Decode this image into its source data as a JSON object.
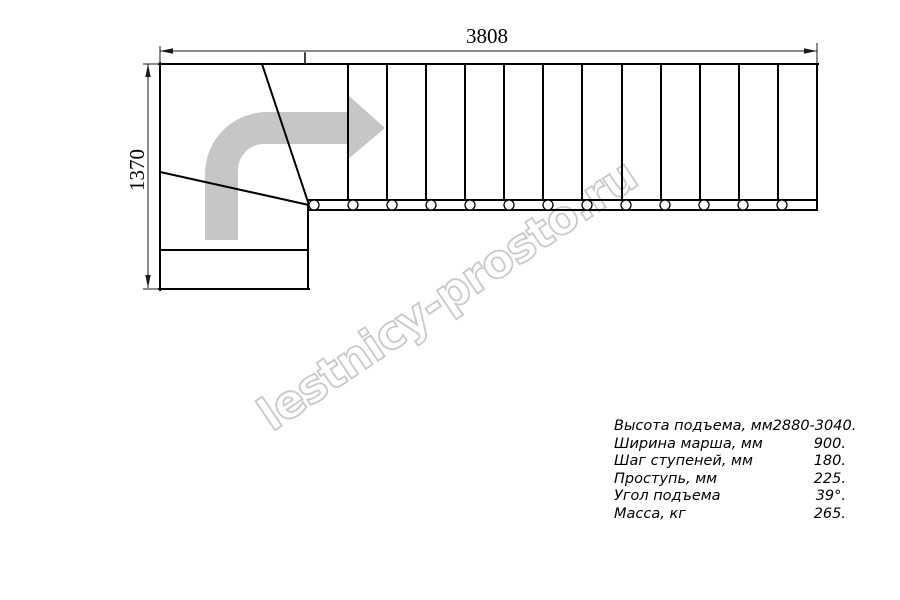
{
  "watermark": {
    "text": "lestnicy-prosto.ru"
  },
  "dimensions": {
    "width_label": "3808",
    "height_label": "1370"
  },
  "specs": {
    "rows": [
      {
        "label": "Высота подъема, мм",
        "value": "2880-3040."
      },
      {
        "label": "Ширина марша, мм",
        "value": "900."
      },
      {
        "label": "Шаг ступеней, мм",
        "value": "180."
      },
      {
        "label": "Проступь, мм",
        "value": "225."
      },
      {
        "label": "Угол подъема",
        "value": "39°."
      },
      {
        "label": "Масса, кг",
        "value": "265."
      }
    ]
  },
  "colors": {
    "line": "#000000",
    "dimension_line": "#1a1a1a",
    "arrow_gray": "#c6c6c6",
    "watermark_gray": "#c9c9c9",
    "background": "#ffffff"
  }
}
